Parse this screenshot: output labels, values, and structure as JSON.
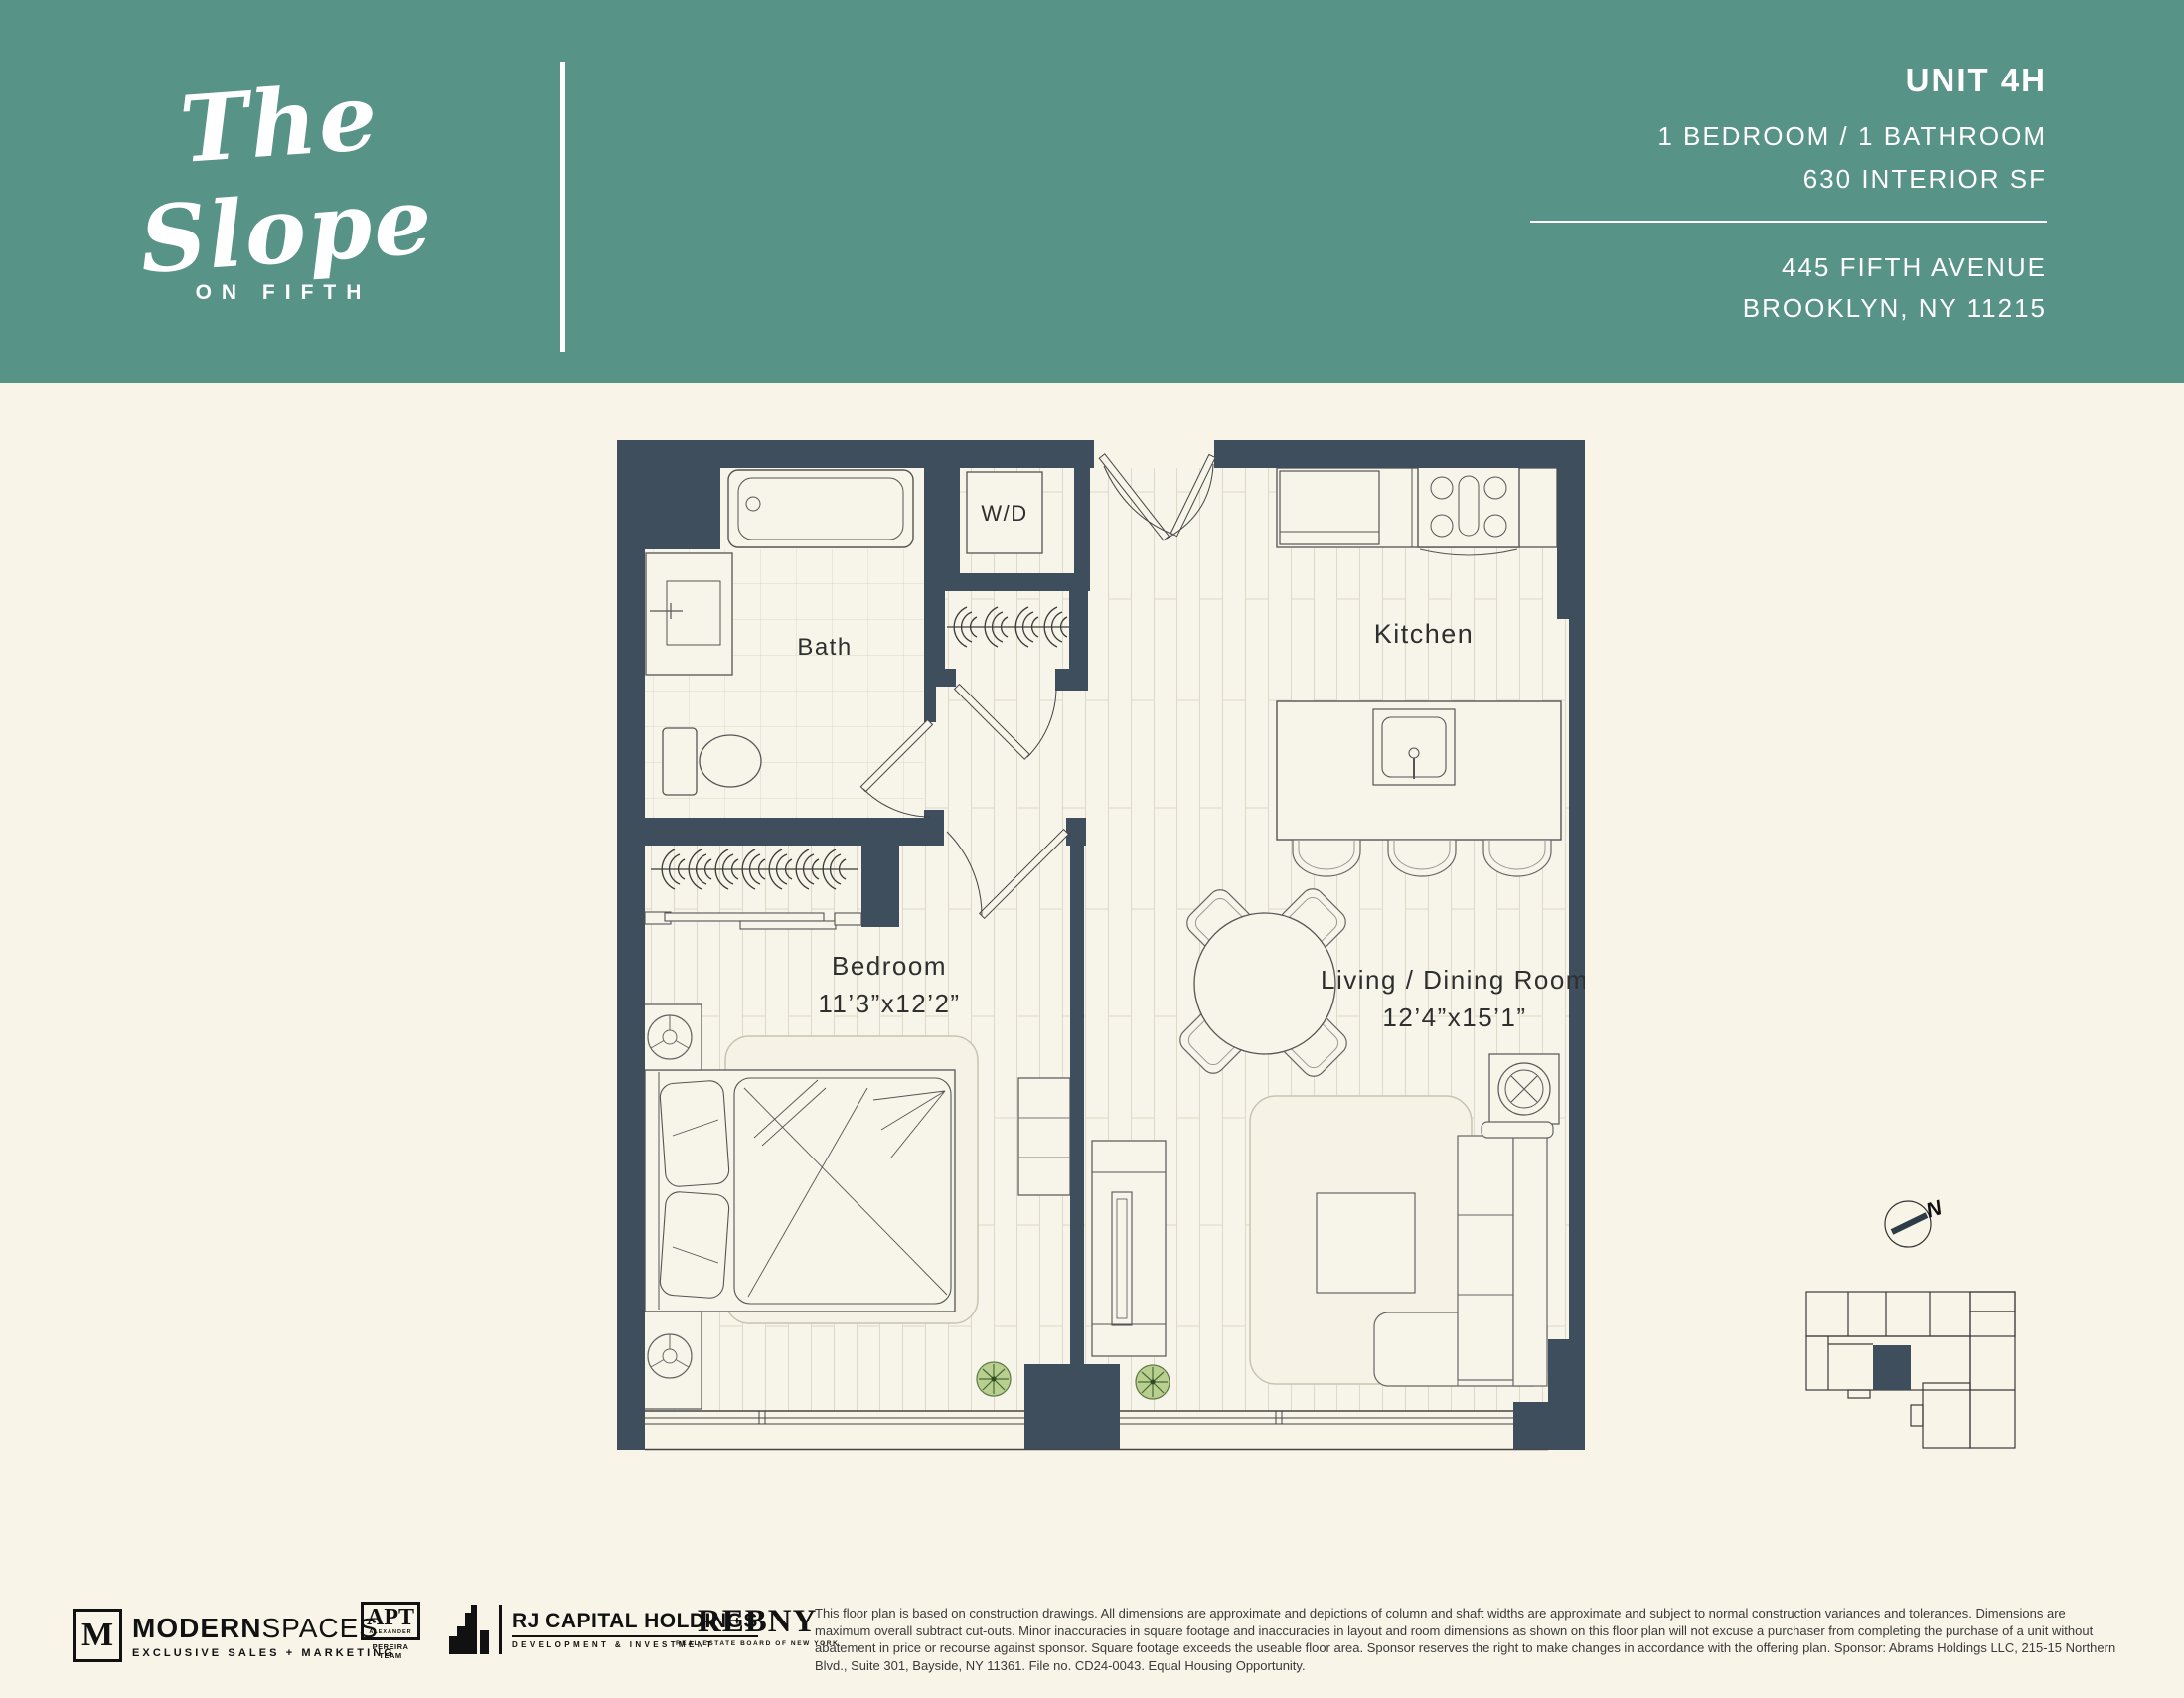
{
  "header": {
    "logo_script": "The Slope",
    "logo_sub": "ON FIFTH",
    "unit_label": "UNIT 4H",
    "spec_line": "1 BEDROOM  /  1 BATHROOM",
    "area_line": "630 INTERIOR SF",
    "address_line1": "445 FIFTH AVENUE",
    "address_line2": "BROOKLYN, NY 11215"
  },
  "floorplan": {
    "labels": {
      "bath": "Bath",
      "washer_dryer": "W/D",
      "kitchen": "Kitchen",
      "bedroom_name": "Bedroom",
      "bedroom_dims": "11’3”x12’2”",
      "living_name": "Living / Dining Room",
      "living_dims": "12’4”x15’1”"
    },
    "colors": {
      "wall": "#3E4E5C",
      "header_band": "#579387",
      "page_background": "#F8F4E7",
      "floor": "#F7F4E9",
      "plant": "#B8CF8F"
    }
  },
  "keyplan": {
    "north_label": "N"
  },
  "footer": {
    "modern_spaces": {
      "monogram": "M",
      "name_bold": "MODERN",
      "name_light": "SPACES",
      "tagline": "EXCLUSIVE SALES + MARKETING"
    },
    "apt": {
      "abbr": "APT",
      "sub1": "ALEXANDER",
      "sub2": "PEREIRA TEAM"
    },
    "rj_capital": {
      "name": "RJ CAPITAL HOLDINGS",
      "tagline": "DEVELOPMENT & INVESTMENT"
    },
    "rebny": {
      "name": "REBNY",
      "tagline": "REAL ESTATE BOARD OF NEW YORK"
    },
    "disclaimer": "This floor plan is based on construction drawings. All dimensions are approximate and depictions of column and shaft widths are approximate and subject to normal construction variances and tolerances. Dimensions are maximum overall subtract cut-outs. Minor inaccuracies in square footage and inaccuracies in layout and room dimensions as shown on this floor plan will not excuse a purchaser from completing the purchase of a unit without abatement in price or recourse against sponsor. Square footage exceeds the useable floor area. Sponsor reserves the right to make changes in accordance with the offering plan. Sponsor: Abrams Holdings LLC, 215-15 Northern Blvd., Suite 301, Bayside, NY 11361. File no. CD24-0043. Equal Housing Opportunity."
  }
}
